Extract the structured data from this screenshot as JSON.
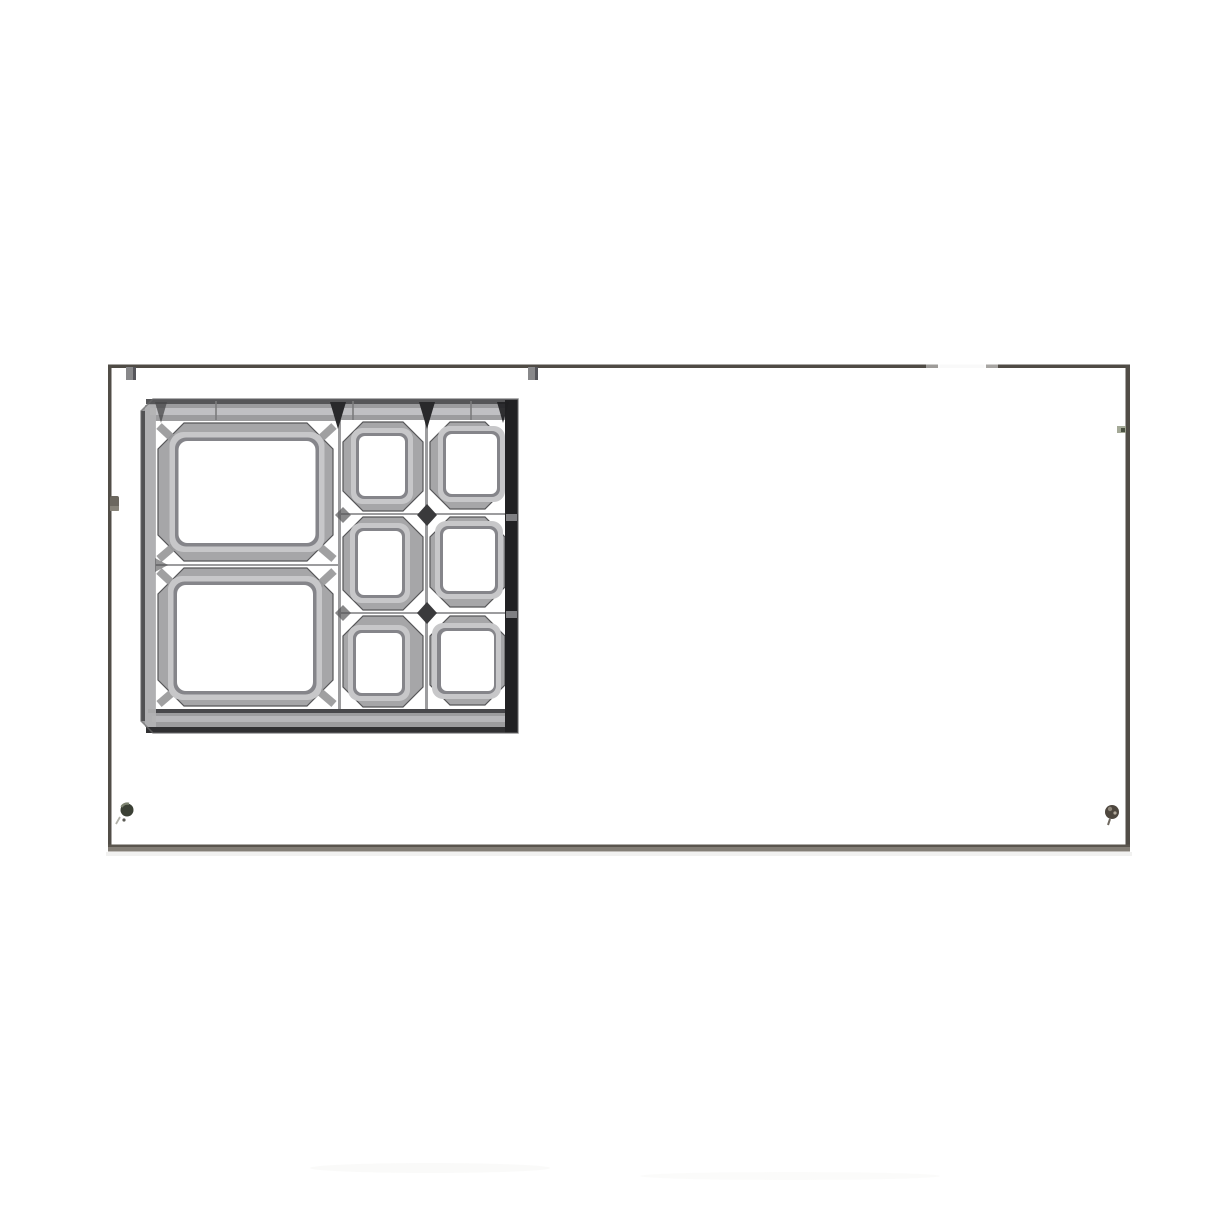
{
  "scene": {
    "type": "photograph",
    "description": "Top-down photograph of a white rectangular panel outlined by a thin dark frame; a gray cast-metal bracket with two large rectangular openings and a 2x3 grid of six smaller square openings occupies the upper-left region",
    "background_color": "#ffffff"
  },
  "palette": {
    "frame_line": "#514d47",
    "frame_line_top": "#4f4b45",
    "frame_line_bottom": "#837e76",
    "frame_line_bottom_edge": "#5a554e",
    "steel_base": "#9c9c9e",
    "steel_mid": "#a6a6a8",
    "steel_light": "#c7c7c9",
    "steel_bevel_dark": "#85858a",
    "steel_shadow": "#565658",
    "steel_dark": "#3a3a3c",
    "steel_black": "#212123",
    "screw_olive": "#3b4035",
    "screw_brown": "#4e473f",
    "clip_gray": "#88888a",
    "tab_olive": "#6b675f",
    "paper_white": "#ffffff"
  },
  "panel": {
    "shape": "rectangle",
    "border_sides": 4,
    "glare_on_top_edge": true,
    "top_edge_clips": 2,
    "left_edge_tabs": 1,
    "right_edge_specks": 1,
    "screws": [
      {
        "position": "bottom-left",
        "color": "#3b4035"
      },
      {
        "position": "bottom-right",
        "color": "#4e473f"
      }
    ]
  },
  "casting": {
    "material_look": "cast gray metal",
    "position": "upper-left of panel",
    "large_openings_count": 2,
    "large_openings_layout": "stacked vertically, left column",
    "small_openings_count": 6,
    "small_openings_grid": {
      "rows": 3,
      "columns": 2
    },
    "corner_gussets": true,
    "dark_right_rail": true,
    "beveled_opening_frames": true
  }
}
